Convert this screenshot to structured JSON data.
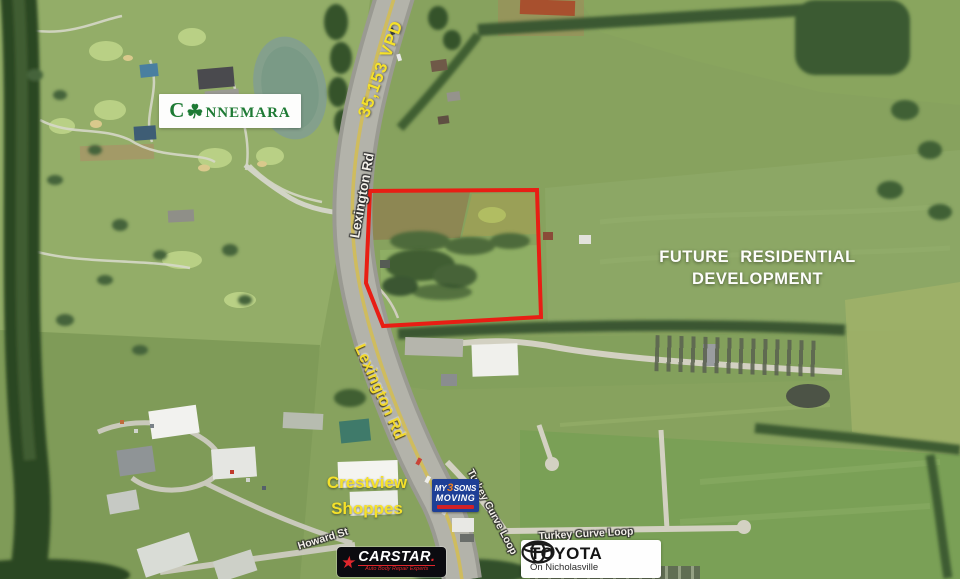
{
  "map": {
    "description": "Aerial parcel marketing map, Nicholasville KY area",
    "labels": {
      "connemara_prefix": "C",
      "connemara_suffix": "nnemara",
      "traffic_count": "35,153 VPD",
      "road_upper": "Lexington Rd",
      "road_lower": "Lexington Rd",
      "future_line1": "FUTURE RESIDENTIAL",
      "future_line2": "DEVELOPMENT",
      "crestview_line1": "Crestview",
      "crestview_line2": "Shoppes",
      "turkey_curve_rotated": "Turkey Curve Loop",
      "turkey_curve_horizontal": "Turkey Curve Loop",
      "howard_street": "Howard St"
    },
    "icons": {
      "shamrock": "☘",
      "carstar_star": "★"
    },
    "logos": {
      "my3sons": {
        "word1": "MY",
        "digit": "3",
        "word2": "SONS",
        "word3": "MOVING"
      },
      "carstar": {
        "name": "CARSTAR",
        "dot": ".",
        "tagline": "Auto Body Repair Experts"
      },
      "toyota": {
        "name": "TOYOTA",
        "tagline": "On Nicholasville"
      }
    },
    "colors": {
      "parcel_outline": "#e81e14",
      "traffic_yellow": "#f5e12a",
      "road_label_white": "#f2efe8",
      "connemara_green": "#1e7a34",
      "my3sons_blue": "#1e3f96",
      "carstar_red": "#e0262c",
      "toyota_black": "#141414"
    }
  }
}
